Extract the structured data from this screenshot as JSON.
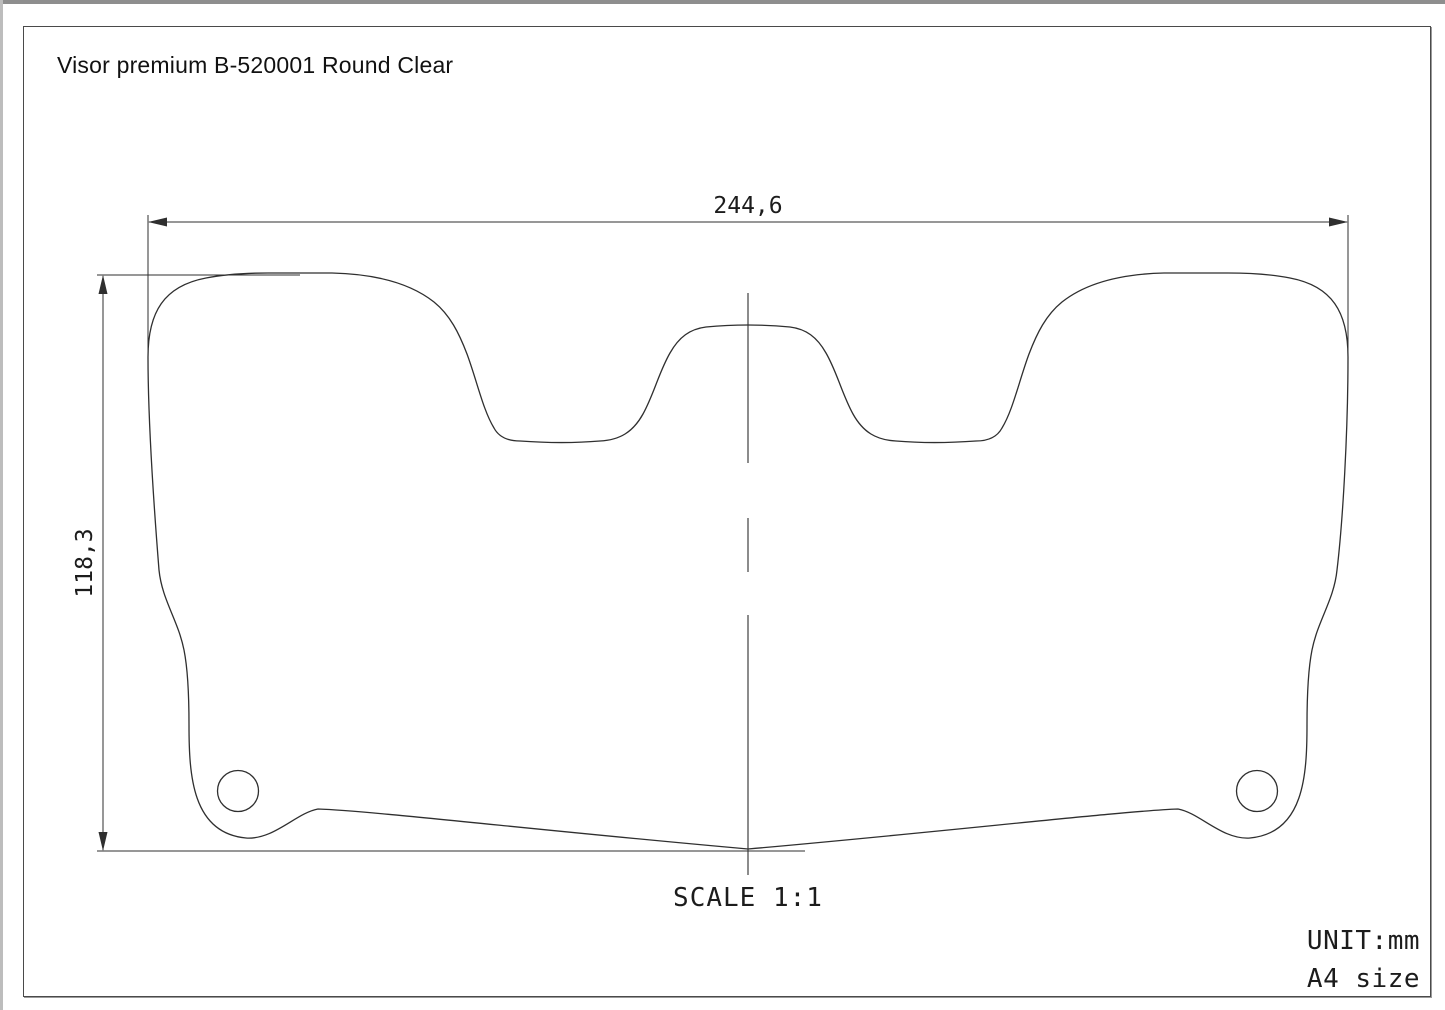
{
  "header": {
    "title": "Visor premium B-520001 Round Clear"
  },
  "dimensions": {
    "width": {
      "value": "244,6",
      "unit": "mm",
      "orientation": "horizontal"
    },
    "height": {
      "value": "118,3",
      "unit": "mm",
      "orientation": "vertical"
    }
  },
  "drawing": {
    "part": "visor",
    "features": [
      "visor-outline",
      "left-mounting-hole",
      "right-mounting-hole",
      "vertical-centerline"
    ]
  },
  "footer": {
    "scale": "SCALE 1:1",
    "unit": "UNIT:mm",
    "paper_size": "A4 size"
  },
  "colors": {
    "line": "#2f2f2f",
    "frame": "#4a4a4a",
    "paper": "#ffffff"
  }
}
